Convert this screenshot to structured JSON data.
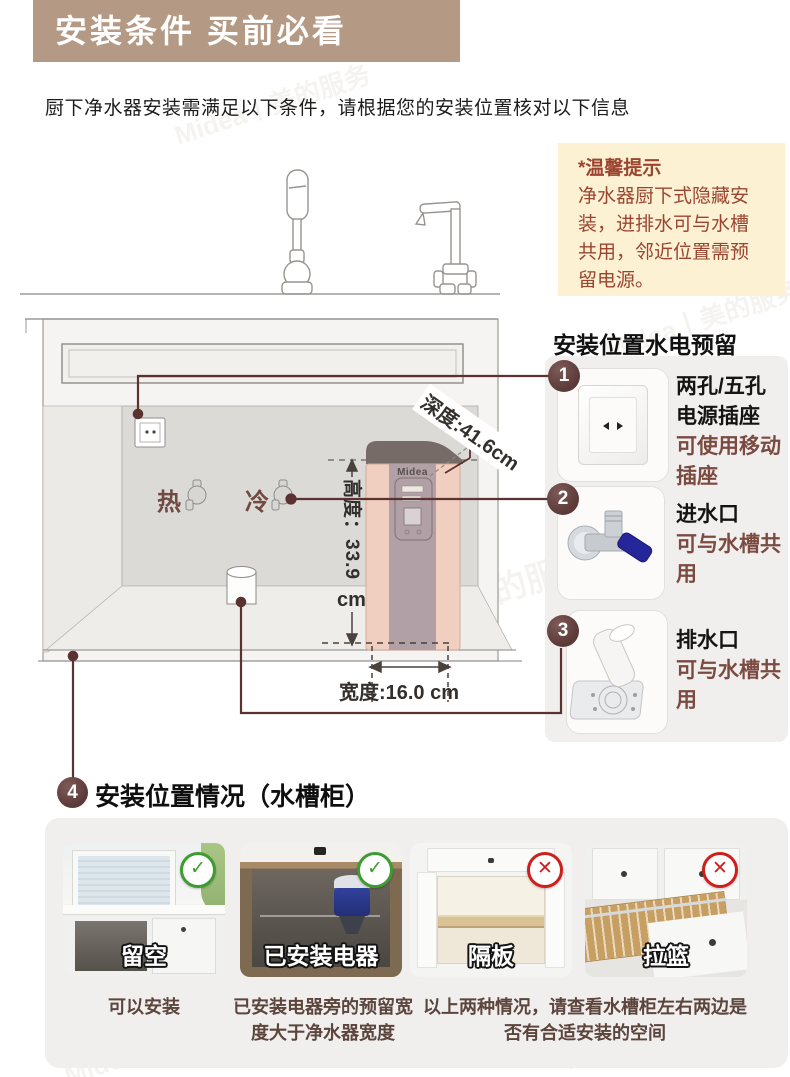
{
  "banner": {
    "title": "安装条件 买前必看"
  },
  "intro": {
    "text": "厨下净水器安装需满足以下条件，请根据您的安装位置核对以下信息"
  },
  "tip": {
    "title": "*温馨提示",
    "body": "净水器厨下式隐藏安装，进排水可与水槽共用，邻近位置需预留电源。"
  },
  "diagram": {
    "brand": "Midea",
    "hot": "热",
    "cold": "冷",
    "depth": "深度:41.6cm",
    "height": "高度：33.9",
    "height_unit": "cm",
    "width": "宽度:16.0 cm"
  },
  "right_panel": {
    "heading": "安装位置水电预留",
    "items": [
      {
        "num": "1",
        "icon": "power-outlet",
        "name": "两孔/五孔电源插座",
        "note": "可使用移动插座"
      },
      {
        "num": "2",
        "icon": "inlet-valve",
        "name": "进水口",
        "note": "可与水槽共用"
      },
      {
        "num": "3",
        "icon": "floor-drain",
        "name": "排水口",
        "note": "可与水槽共用"
      }
    ]
  },
  "section": {
    "num": "4",
    "heading": "安装位置情况（水槽柜）",
    "cards": [
      {
        "label": "留空",
        "status": "ok"
      },
      {
        "label": "已安装电器",
        "status": "ok"
      },
      {
        "label": "隔板",
        "status": "no"
      },
      {
        "label": "拉篮",
        "status": "no"
      }
    ],
    "captions": {
      "c1": "可以安装",
      "c2": "已安装电器旁的预留宽度大于净水器宽度",
      "c3": "以上两种情况，请查看水槽柜左右两边是否有合适安装的空间"
    }
  },
  "icons": {
    "ok": "✓",
    "no": "✕"
  },
  "watermark": "Midea丨美的服务",
  "colors": {
    "banner": "#b49a84",
    "tip_bg": "#fcf1d3",
    "tip_text": "#9b4531",
    "badge": "#5c3a39",
    "callout": "#5a3331",
    "maroon_text": "#7b4b41",
    "ok_green": "#3e9b31",
    "no_red": "#cf1f1c"
  }
}
